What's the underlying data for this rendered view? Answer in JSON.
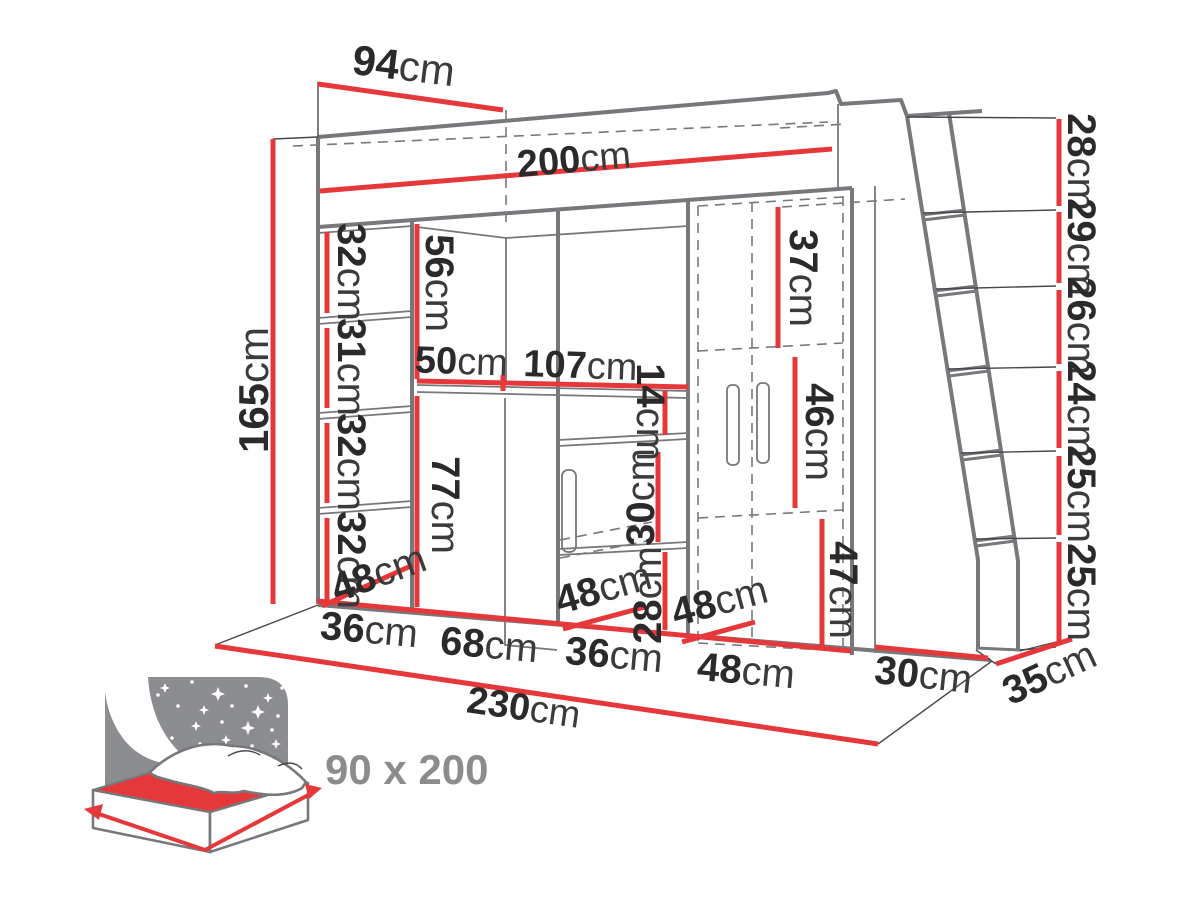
{
  "diagram": {
    "type": "furniture-dimension-drawing",
    "subject": "loft bed with wardrobe, desk, shelves and ladder"
  },
  "colors": {
    "dimension_red": "#e6383b",
    "outline_gray": "#77787b",
    "label_dark": "#2b292a",
    "label_gray": "#8b8c8e"
  },
  "dims": {
    "top_depth": {
      "num": "94",
      "unit": "cm"
    },
    "bed_length": {
      "num": "200",
      "unit": "cm"
    },
    "total_height": {
      "num": "165",
      "unit": "cm"
    },
    "shelf_1": {
      "num": "32",
      "unit": "cm"
    },
    "shelf_2": {
      "num": "31",
      "unit": "cm"
    },
    "shelf_3": {
      "num": "32",
      "unit": "cm"
    },
    "shelf_4": {
      "num": "32",
      "unit": "cm"
    },
    "cubby_height": {
      "num": "56",
      "unit": "cm"
    },
    "desk_return_depth": {
      "num": "50",
      "unit": "cm"
    },
    "desk_width": {
      "num": "107",
      "unit": "cm"
    },
    "niche_height": {
      "num": "14",
      "unit": "cm"
    },
    "desk_height": {
      "num": "77",
      "unit": "cm"
    },
    "cabinet_opening_height": {
      "num": "30",
      "unit": "cm"
    },
    "drawer_height": {
      "num": "28",
      "unit": "cm"
    },
    "wardrobe_top_section": {
      "num": "37",
      "unit": "cm"
    },
    "wardrobe_middle_section": {
      "num": "46",
      "unit": "cm"
    },
    "wardrobe_bottom_section": {
      "num": "47",
      "unit": "cm"
    },
    "depth_left": {
      "num": "48",
      "unit": "cm"
    },
    "depth_middle": {
      "num": "48",
      "unit": "cm"
    },
    "depth_right": {
      "num": "48",
      "unit": "cm"
    },
    "width_shelf_column": {
      "num": "36",
      "unit": "cm"
    },
    "width_desk_bay": {
      "num": "68",
      "unit": "cm"
    },
    "width_cabinet": {
      "num": "36",
      "unit": "cm"
    },
    "width_wardrobe": {
      "num": "48",
      "unit": "cm"
    },
    "width_ladder_bay": {
      "num": "30",
      "unit": "cm"
    },
    "ladder_depth": {
      "num": "35",
      "unit": "cm"
    },
    "total_width": {
      "num": "230",
      "unit": "cm"
    },
    "ladder_steps": [
      {
        "num": "28",
        "unit": "cm"
      },
      {
        "num": "29",
        "unit": "cm"
      },
      {
        "num": "26",
        "unit": "cm"
      },
      {
        "num": "24",
        "unit": "cm"
      },
      {
        "num": "25",
        "unit": "cm"
      },
      {
        "num": "25",
        "unit": "cm"
      }
    ],
    "mattress_size": "90 x 200"
  }
}
